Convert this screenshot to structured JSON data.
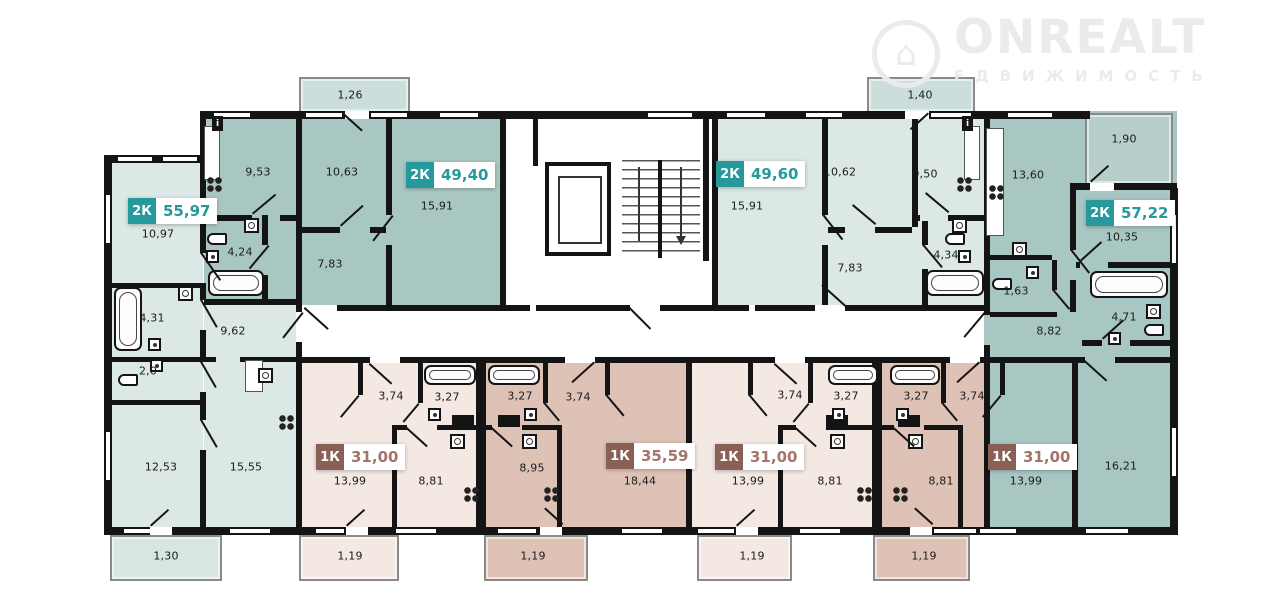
{
  "logo": {
    "brand": "ONREALT",
    "subtitle": "ЕДВИЖИМОСТЬ"
  },
  "icons": {
    "logo_house": "⌂",
    "info": "i"
  },
  "palette": {
    "teal_accent": "#25999b",
    "rose_accent": "#8a6054",
    "apartment_teal_light": "#dbe8e6",
    "apartment_teal_medium": "#a8c6c2",
    "apartment_pink_light": "#f4e8e3",
    "apartment_rose": "#dfc2b6",
    "walls": "#141414"
  },
  "apartments": {
    "a": {
      "type": "2К",
      "area": "55,97",
      "rooms": {
        "main": "10,97",
        "bath": "4,31",
        "wc": "2,0",
        "hall": "9,62",
        "bedroom": "12,53",
        "kitchen": "15,55",
        "balcony": "1,30"
      }
    },
    "b": {
      "type": "2К",
      "area": "49,40",
      "rooms": {
        "kitchen": "9,53",
        "bedroom": "10,63",
        "living": "15,91",
        "bath": "4,24",
        "hall": "7,83",
        "balcony": "1,26"
      }
    },
    "c": {
      "type": "2К",
      "area": "49,60",
      "rooms": {
        "living": "15,91",
        "bedroom": "10,62",
        "kitchen": "9,50",
        "bath": "4,34",
        "hall": "7,83",
        "balcony": "1,40"
      }
    },
    "d": {
      "type": "2К",
      "area": "57,22",
      "rooms": {
        "kitchen": "13,60",
        "room": "10,35",
        "loggia": "1,90",
        "wc": "1,63",
        "hall": "8,82",
        "bath": "4,71",
        "living": "16,21"
      }
    },
    "e": {
      "type": "1К",
      "area": "31,00",
      "rooms": {
        "hall": "3,74",
        "bath": "3,27",
        "living": "13,99",
        "kitchen": "8,81",
        "balcony": "1,19"
      }
    },
    "f": {
      "type": "1К",
      "area": "35,59",
      "rooms": {
        "bath": "3,27",
        "hall": "3,74",
        "kitchen": "8,95",
        "living": "18,44",
        "balcony": "1,19"
      }
    },
    "g": {
      "type": "1К",
      "area": "31,00",
      "rooms": {
        "hall": "3,74",
        "bath": "3,27",
        "living": "13,99",
        "kitchen": "8,81",
        "balcony": "1,19"
      }
    },
    "h": {
      "type": "1К",
      "area": "31,00",
      "rooms": {
        "bath": "3,27",
        "hall": "3,74",
        "kitchen": "8,81",
        "living": "13,99",
        "balcony": "1,19"
      }
    }
  }
}
